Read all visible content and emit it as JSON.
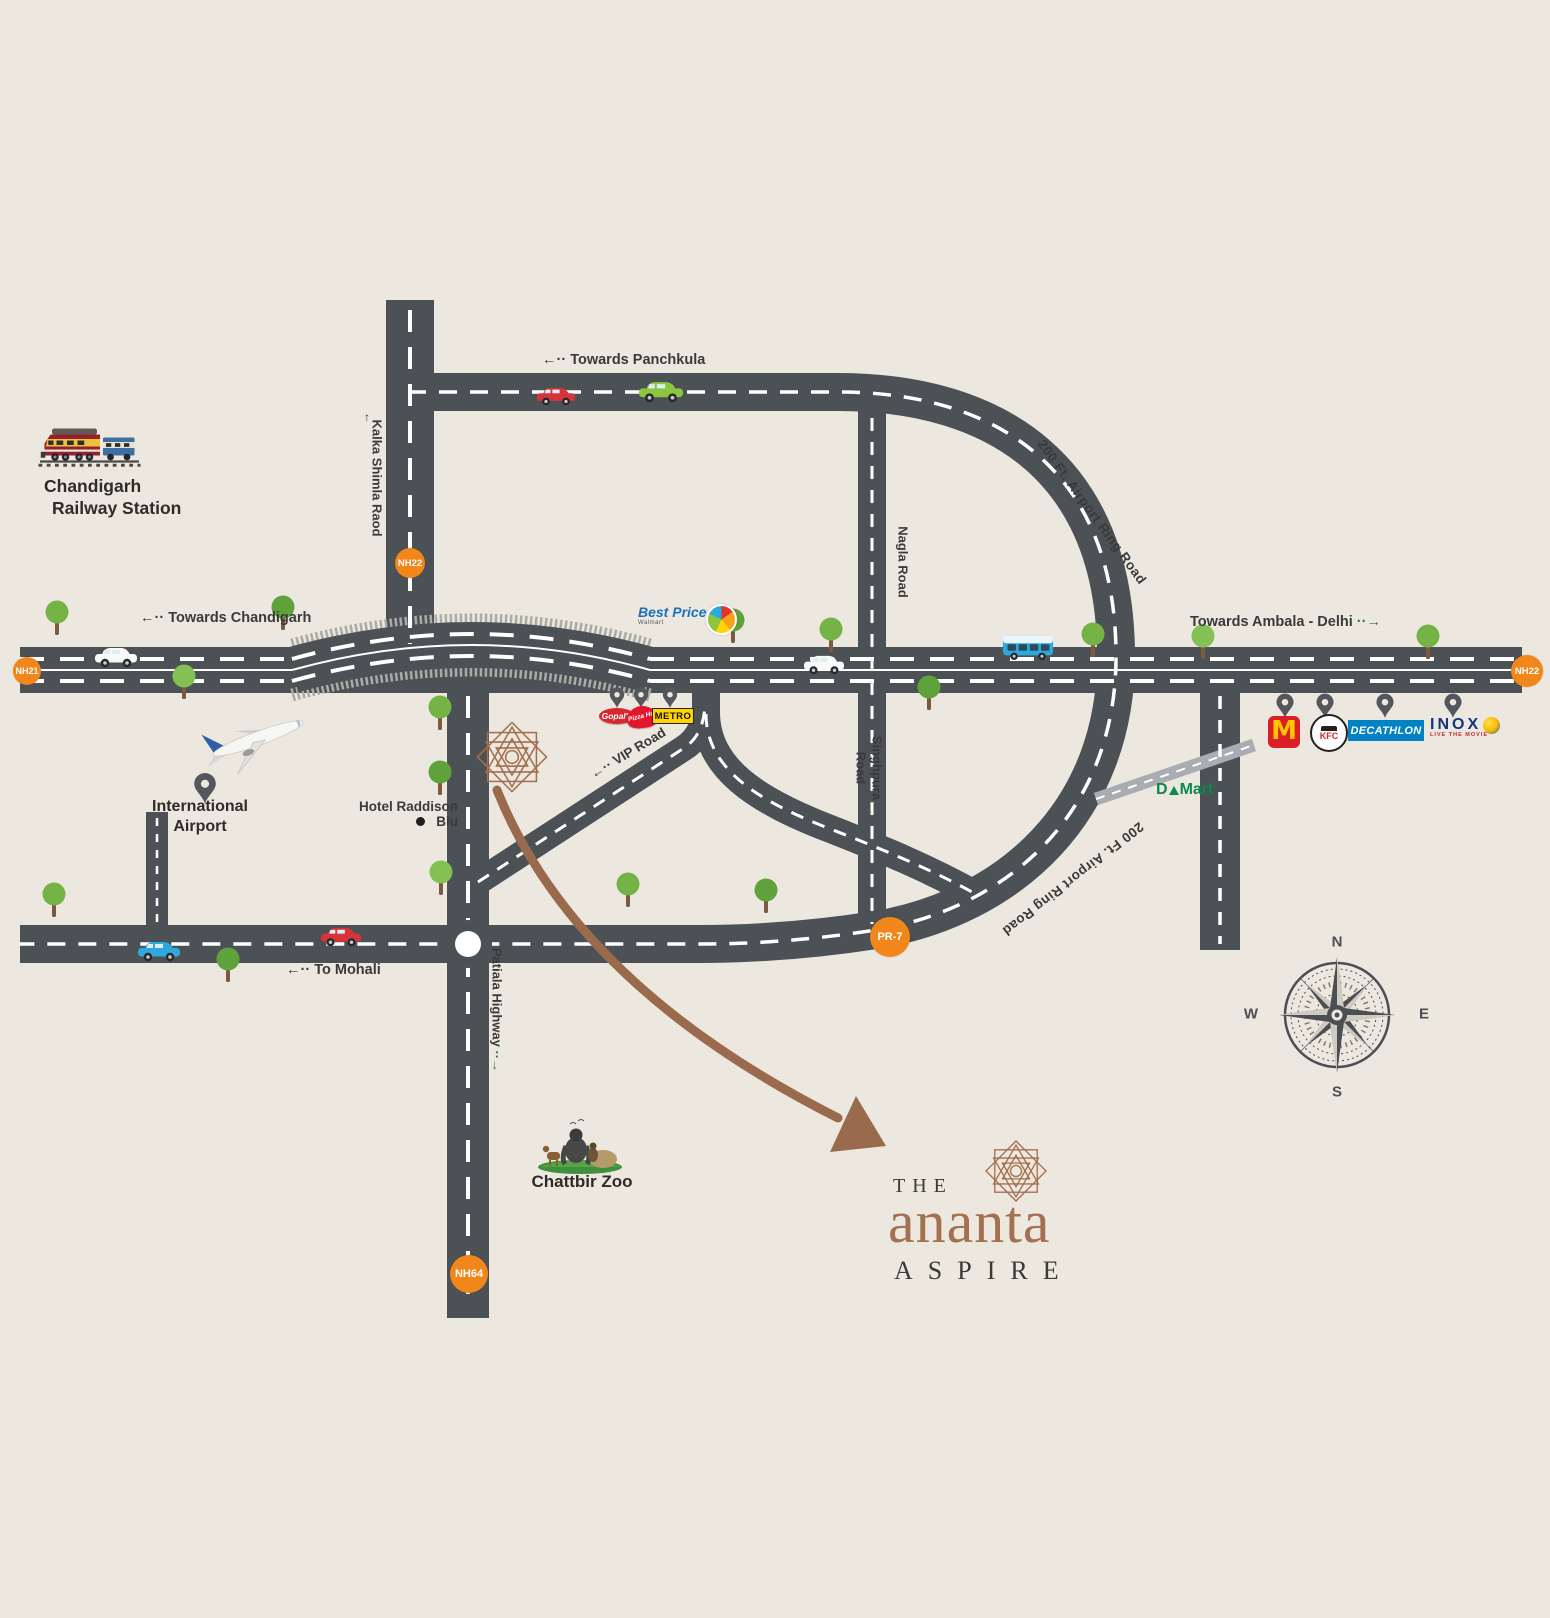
{
  "map": {
    "labels": {
      "towards_panchkula": {
        "arrow": "←··",
        "text": "Towards Panchkula"
      },
      "towards_chandigarh": {
        "arrow": "←··",
        "text": "Towards Chandigarh"
      },
      "towards_ambala": {
        "text": "Towards Ambala - Delhi",
        "arrow": "··→"
      },
      "to_mohali": {
        "arrow": "←··",
        "text": "To Mohali"
      },
      "vip_road": {
        "arrow": "←··",
        "text": "VIP Road"
      },
      "kalka_shimla": {
        "arrow": "↑",
        "text": "Kalka Shimla Raod"
      },
      "nagla_road": "Nagla Road",
      "singhpura_road": {
        "line1": "Singhpura",
        "line2": "Road",
        "arrow": "··→"
      },
      "patiala_highway": {
        "text": "Patiala Highway",
        "arrow": "··→"
      },
      "ring_road_upper": "200 Ft. Airport Ring Road",
      "ring_road_lower": "200 Ft. Airport Ring Road"
    },
    "badges": {
      "nh21": "NH21",
      "nh22_top": "NH22",
      "nh22_right": "NH22",
      "pr7": "PR-7",
      "nh64": "NH64"
    },
    "places": {
      "railway": {
        "line1": "Chandigarh",
        "line2": "Railway Station"
      },
      "airport": {
        "line1": "International",
        "line2": "Airport"
      },
      "hotel": "Hotel Raddison Blu",
      "zoo": "Chattbir Zoo",
      "dmart": {
        "d": "D",
        "mart": "Mart"
      }
    },
    "logos": {
      "best_price": {
        "text": "Best Price",
        "sub": "Walmart"
      },
      "gopals": "Gopal's",
      "pizza_hut": "Pizza Hut",
      "metro": "METRO",
      "mcdonalds": "M",
      "kfc": "KFC",
      "decathlon": "DECATHLON",
      "inox": {
        "text": "INOX",
        "sub": "LIVE THE MOVIE"
      }
    },
    "compass": {
      "n": "N",
      "e": "E",
      "s": "S",
      "w": "W"
    }
  },
  "branding": {
    "the": "THE",
    "name": "ananta",
    "tagline": "ASPIRE"
  },
  "colors": {
    "background": "#EDE8DF",
    "road": "#4C5156",
    "badge_orange": "#F1861B",
    "brand_brown": "#A3714F",
    "arrow_green": "#2E7D32",
    "tree_green": "#76B347",
    "dmart_green": "#0B8A4D"
  }
}
